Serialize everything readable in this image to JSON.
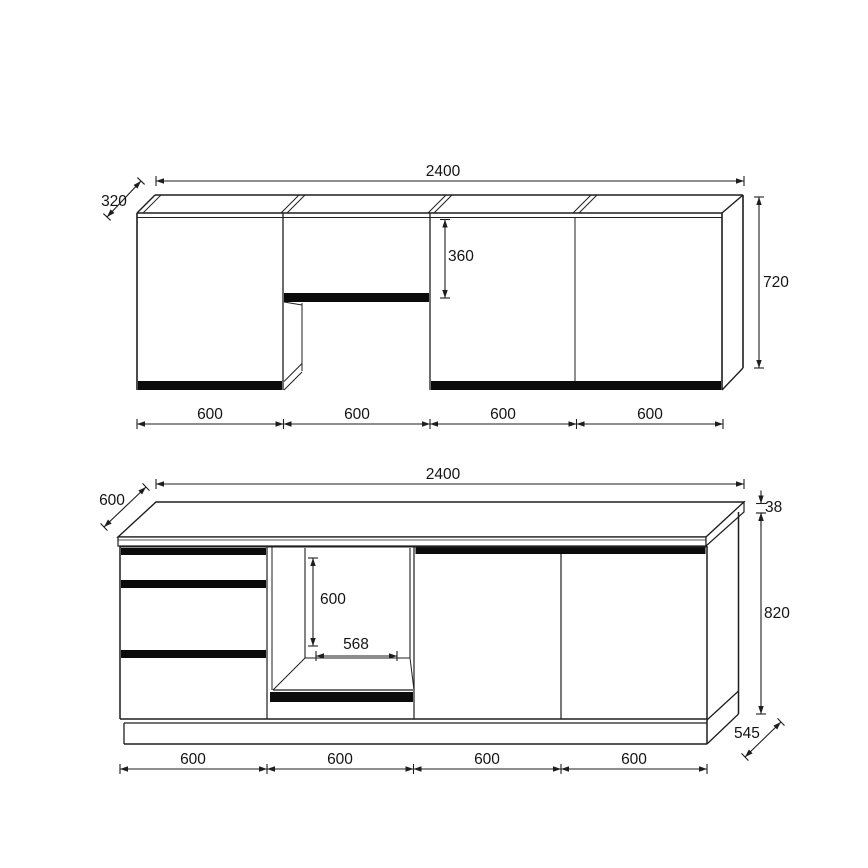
{
  "upper_drawing": {
    "total_width": "2400",
    "depth": "320",
    "flap_opening_height": "360",
    "height": "720",
    "section_widths": [
      "600",
      "600",
      "600",
      "600"
    ]
  },
  "base_drawing": {
    "total_width": "2400",
    "worktop_depth": "600",
    "worktop_thickness": "38",
    "height": "820",
    "niche_height": "600",
    "niche_width": "568",
    "plinth_depth": "545",
    "section_widths": [
      "600",
      "600",
      "600",
      "600"
    ]
  }
}
